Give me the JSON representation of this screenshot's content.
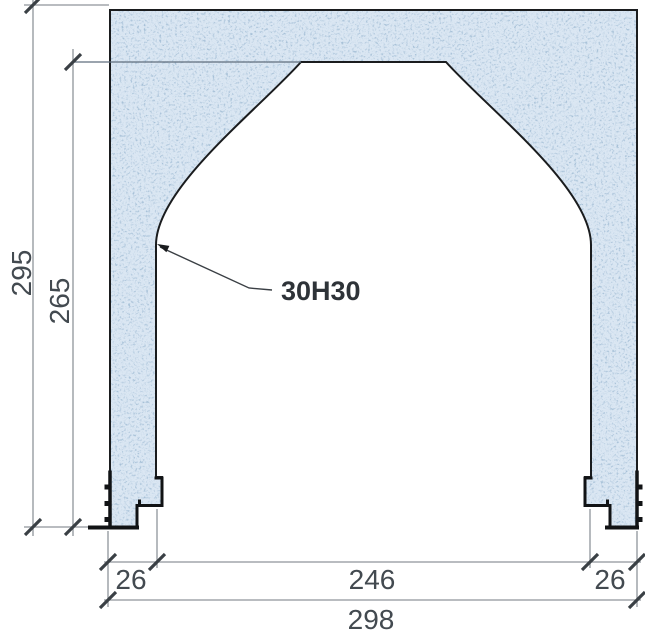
{
  "diagram": {
    "callout": {
      "label": "30H30"
    },
    "dimensions": {
      "height_total": {
        "label": "295"
      },
      "height_opening": {
        "label": "265"
      },
      "width_left": {
        "label": "26"
      },
      "width_opening": {
        "label": "246"
      },
      "width_right": {
        "label": "26"
      },
      "width_total": {
        "label": "298"
      }
    },
    "colors": {
      "concrete_fill": "#dbe7f3",
      "speckle_dark": "#54749c",
      "speckle_light": "#8fadcd",
      "outline": "#1a1c1e",
      "profile_steel": "#111315",
      "dimension_line": "#8f959a",
      "tick": "#3a4045",
      "label_text": "#434a50",
      "callout_text": "#2e3338"
    }
  }
}
